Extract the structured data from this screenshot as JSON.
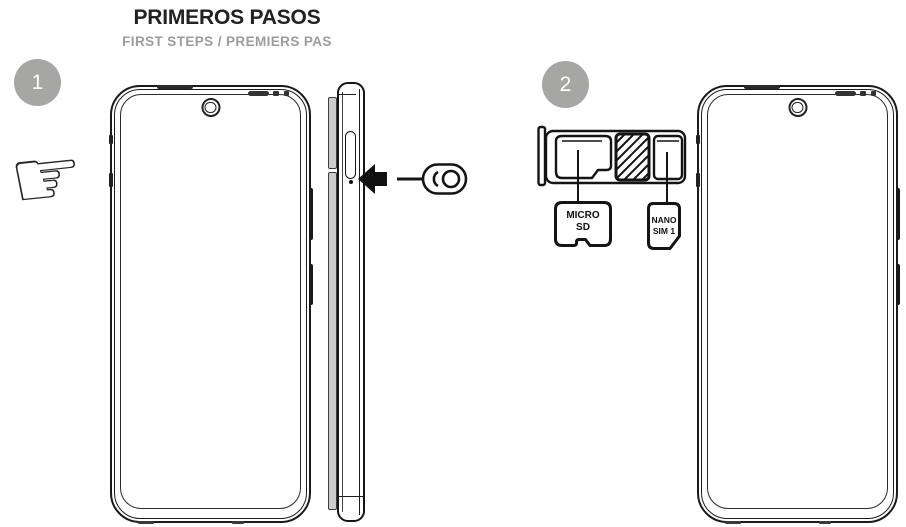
{
  "header": {
    "title": "PRIMEROS PASOS",
    "subtitle": "FIRST STEPS / PREMIERS PAS"
  },
  "steps": [
    {
      "number": "1"
    },
    {
      "number": "2"
    }
  ],
  "hand_glyph": "☞",
  "tray_labels": {
    "micro_sd": "MICRO\nSD",
    "nano_sim": "NANO\nSIM 1"
  },
  "colors": {
    "outline": "#1a1a1a",
    "badge_gray": "#a6a6a4",
    "subtitle_gray": "#9c9c9c",
    "rail_gray": "#cdcdcd"
  }
}
